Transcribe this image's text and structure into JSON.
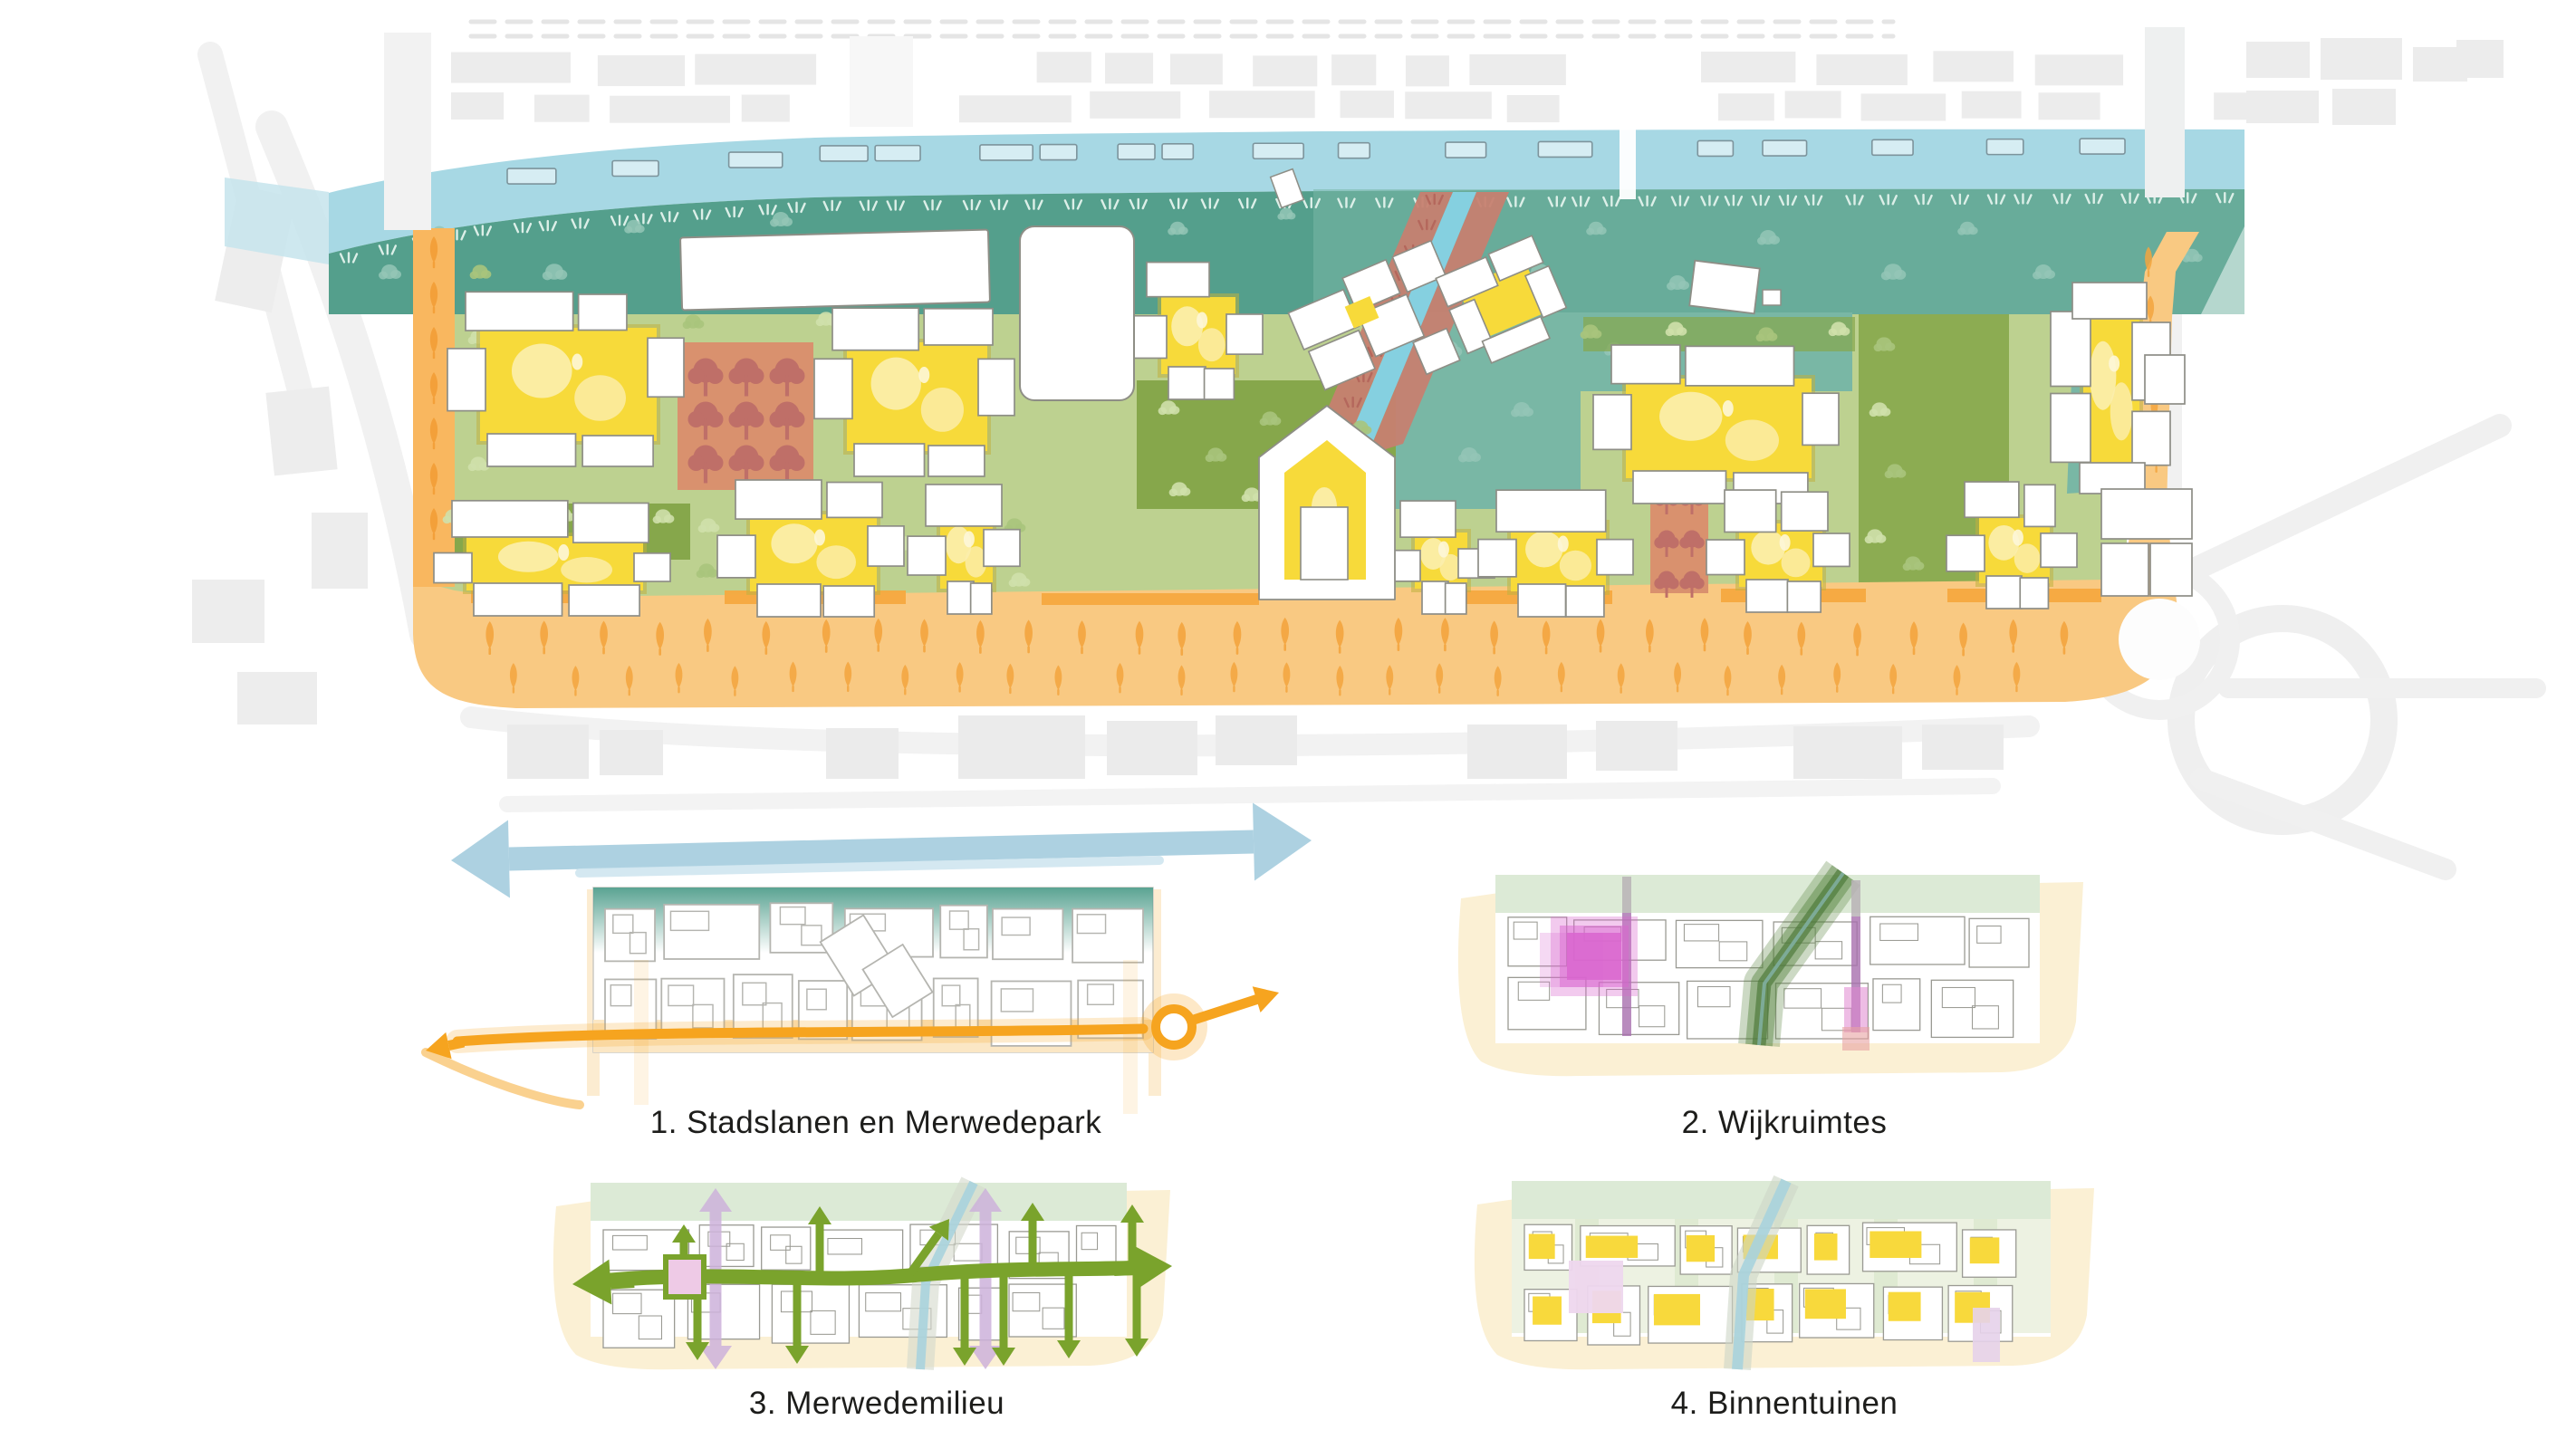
{
  "page": {
    "background": "#ffffff"
  },
  "diagrams": [
    {
      "label": "1. Stadslanen en Merwedepark"
    },
    {
      "label": "2. Wijkruimtes"
    },
    {
      "label": "3. Merwedemilieu"
    },
    {
      "label": "4. Binnentuinen"
    }
  ],
  "palette": {
    "water": "#a7d8e4",
    "water_light": "#c5e4ec",
    "boat": "#d6edf3",
    "boat_stroke": "#7d949c",
    "park_teal": "#549f8c",
    "park_teal_light": "#79b7a5",
    "tree_teal": "#94c6b6",
    "grass_teal": "#dcefe8",
    "street_green": "#bdd190",
    "street_green_dark": "#86a74b",
    "tree_green": "#cfe0ab",
    "tree_olive": "#a9c47c",
    "courtyard_yellow": "#f7da3a",
    "courtyard_blob": "#fbeeae",
    "courtyard_shadow": "#c0b03f",
    "building_fill": "#ffffff",
    "building_stroke": "#8e8e86",
    "plaza_terracotta": "#d9916e",
    "plaza_tree": "#bf6f68",
    "canal_blue": "#85d0e0",
    "canal_bank": "#c67f70",
    "canal_grass": "#b4675c",
    "orange_band": "#f9c982",
    "orange_band_strong": "#f6a93f",
    "orange_tree": "#f3a43e",
    "context_grey": "#ececec",
    "road_grey": "#f2f2f2",
    "outline_grey": "#9a9a93",
    "cream": "#fbf0d4",
    "pale_green": "#dcead6",
    "water_arrow": "#a9cfdf",
    "road_orange": "#f6a41f",
    "wijk_purple": "#a86fae",
    "wijk_grey": "#b9b3b6",
    "wijk_magenta": "#d966cf",
    "wijk_pink": "#e087d0",
    "wijk_red_pink": "#e8a1a1",
    "wijk_green_band": "#4e7a3c",
    "milieu_green": "#7aa32c",
    "milieu_lavender": "#cdb2da",
    "milieu_pink": "#eecae6",
    "binnen_yellow": "#f8d93c",
    "binnen_pink": "#eed7ee",
    "mini_canal": "#a9d3dd",
    "caption_color": "#1d1d1b"
  }
}
